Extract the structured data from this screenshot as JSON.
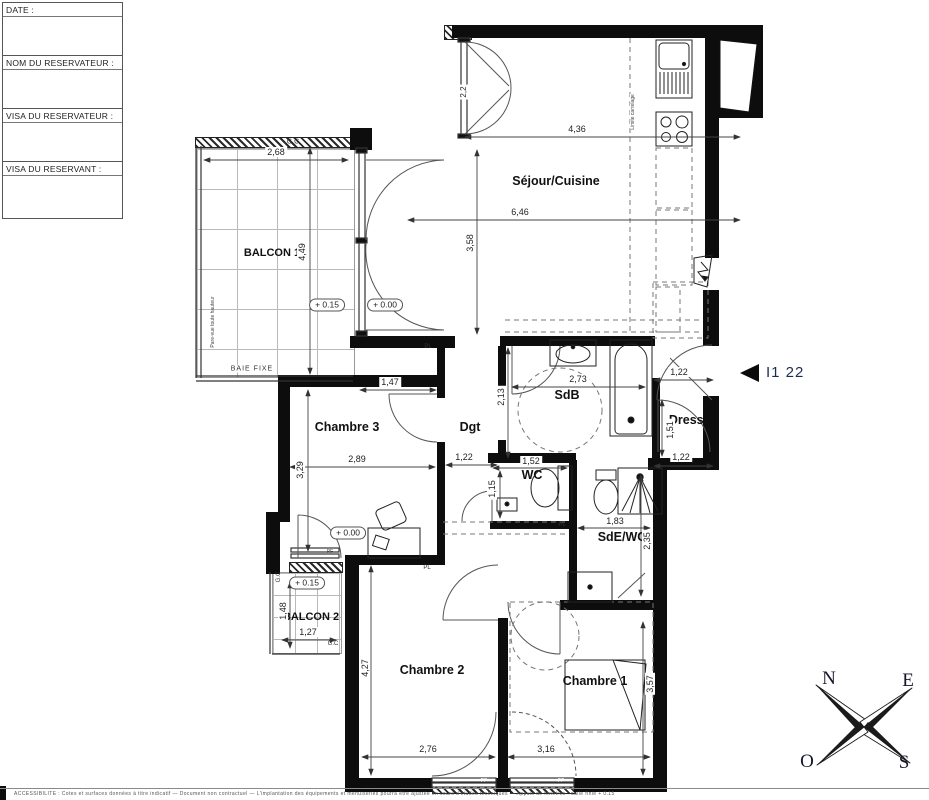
{
  "title_block": {
    "date": "DATE :",
    "nom": "NOM DU RESERVATEUR :",
    "visa_reservateur": "VISA DU RESERVATEUR :",
    "visa_reservant": "VISA DU RESERVANT :"
  },
  "rooms": {
    "balcon1": "BALCON 1",
    "sejour": "Séjour/Cuisine",
    "chambre3": "Chambre 3",
    "dgt": "Dgt",
    "sdb": "SdB",
    "dress": "Dress.",
    "wc": "WC",
    "sde": "SdE/WC",
    "balcon2": "BALCON 2",
    "chambre2": "Chambre 2",
    "chambre1": "Chambre 1"
  },
  "dims": {
    "balcon1_w": "2,68",
    "balcon1_h": "4,49",
    "sejour_w1": "4,36",
    "sejour_w2": "6,46",
    "sejour_h": "3,58",
    "sejour_door": "2,2",
    "ch3_door": "1,47",
    "ch3_w": "2,89",
    "ch3_h": "3,29",
    "dgt_w": "1,22",
    "sdb_w": "2,73",
    "sdb_h": "2,13",
    "dress_w_top": "1,22",
    "dress_h": "1,51",
    "dress_w_bottom": "1,22",
    "wc_w": "1,52",
    "wc_h": "1,15",
    "sde_w": "1,83",
    "sde_h": "2,35",
    "balcon2_h": "1,48",
    "balcon2_w": "1,27",
    "ch2_h": "4,27",
    "ch2_w": "2,76",
    "ch1_w": "3,16",
    "ch1_h": "3,57"
  },
  "levels": {
    "up": "+ 0.15",
    "zero": "+ 0.00"
  },
  "notes": {
    "gc": "G.C",
    "baie_fixe": "BAIE FIXE",
    "pare_vue": "Pare-vue toute hauteur",
    "limite_carrelage": "Limite carrelage",
    "pl": "PL",
    "pf": "PF"
  },
  "unit": {
    "id": "I1 22"
  },
  "compass": {
    "n": "N",
    "e": "E",
    "o": "O",
    "s": "S"
  },
  "footer": {
    "note": "ACCESSIBILITE : Cotes et surfaces données à titre indicatif — Document non contractuel — L'implantation des équipements et menuiseries pourra être ajustée en cours d'études techniques — Appuis de fenêtres : dalle finie + 0.15"
  }
}
